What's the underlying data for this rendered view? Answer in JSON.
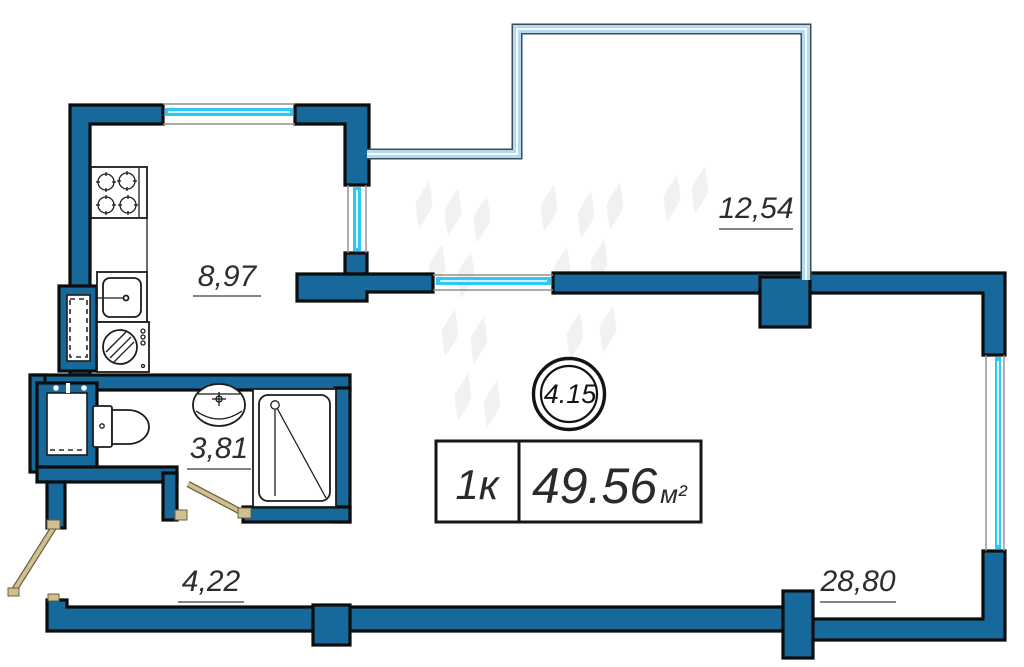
{
  "plan": {
    "unit_circle": {
      "number": "4.15"
    },
    "summary": {
      "rooms_label": "1к",
      "area_value": "49.56",
      "area_unit": "м²"
    },
    "rooms": [
      {
        "name": "kitchen",
        "area": "8,97"
      },
      {
        "name": "loggia",
        "area": "12,54"
      },
      {
        "name": "bathroom",
        "area": "3,81"
      },
      {
        "name": "hallway",
        "area": "4,22"
      },
      {
        "name": "living-room",
        "area": "28,80"
      }
    ],
    "colors": {
      "wall-fill": "#17699b",
      "wall-outline": "#0d0d0d",
      "window-cyan": "#2fc8f2",
      "glazing-light": "#b3daf0",
      "glazing-edge": "#3c4c58",
      "door-tan": "#cfc094",
      "door-edge": "#6e5f39",
      "fixture-stroke": "#1c1c1c",
      "label-text": "#2d2d2d",
      "watermark": "#f1f1f1"
    }
  }
}
